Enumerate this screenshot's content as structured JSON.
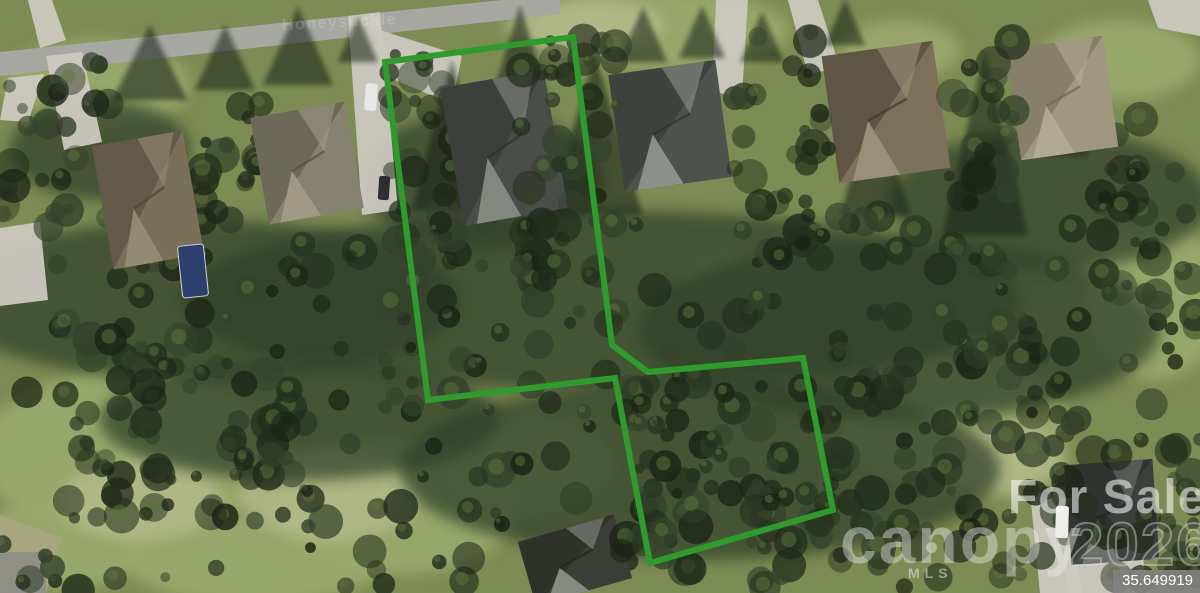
{
  "watermarks": {
    "street_label": "Honeysuckle",
    "for_sale": "For Sale",
    "brand": "canopy",
    "brand_sub": "MLS",
    "year": "2026"
  },
  "coordinate_badge": {
    "value": "35.649919"
  },
  "parcel_boundary": {
    "color": "#2f9b2d",
    "stroke_width": 6,
    "points": [
      [
        385,
        62
      ],
      [
        573,
        37
      ],
      [
        612,
        345
      ],
      [
        648,
        372
      ],
      [
        803,
        358
      ],
      [
        833,
        510
      ],
      [
        650,
        563
      ],
      [
        615,
        378
      ],
      [
        428,
        400
      ]
    ]
  },
  "palette": {
    "grass_base": "#7d8b54",
    "grass_light": "#9cab6e",
    "grass_pale": "#b6bc8c",
    "tree_dark": "#222e1b",
    "tree_mid": "#33422a",
    "tree_deep": "#1a2414",
    "tree_light": "#5d7340",
    "road": "#a7a8a2",
    "concrete": "#ccc9bf",
    "shadow": "rgba(20,28,16,0.55)"
  },
  "scene": {
    "road": [
      [
        0,
        52
      ],
      [
        560,
        -6
      ],
      [
        560,
        14
      ],
      [
        0,
        76
      ]
    ],
    "driveways": [
      {
        "pts": [
          [
            28,
            0
          ],
          [
            52,
            0
          ],
          [
            66,
            40
          ],
          [
            40,
            48
          ]
        ]
      },
      {
        "pts": [
          [
            8,
            78
          ],
          [
            44,
            74
          ],
          [
            28,
            122
          ],
          [
            0,
            120
          ]
        ]
      },
      {
        "pts": [
          [
            46,
            56
          ],
          [
            82,
            52
          ],
          [
            102,
            142
          ],
          [
            64,
            150
          ]
        ]
      },
      {
        "pts": [
          [
            0,
            228
          ],
          [
            40,
            222
          ],
          [
            48,
            300
          ],
          [
            0,
            306
          ]
        ]
      },
      {
        "pts": [
          [
            348,
            16
          ],
          [
            380,
            12
          ],
          [
            398,
            210
          ],
          [
            362,
            215
          ]
        ]
      },
      {
        "pts": [
          [
            380,
            30
          ],
          [
            462,
            56
          ],
          [
            452,
            104
          ],
          [
            376,
            72
          ]
        ]
      },
      {
        "pts": [
          [
            716,
            0
          ],
          [
            748,
            0
          ],
          [
            742,
            96
          ],
          [
            712,
            92
          ]
        ]
      },
      {
        "pts": [
          [
            788,
            0
          ],
          [
            818,
            0
          ],
          [
            840,
            68
          ],
          [
            808,
            74
          ]
        ]
      },
      {
        "pts": [
          [
            1148,
            0
          ],
          [
            1200,
            0
          ],
          [
            1200,
            36
          ],
          [
            1158,
            28
          ]
        ]
      },
      {
        "pts": [
          [
            1030,
            492
          ],
          [
            1064,
            488
          ],
          [
            1082,
            593
          ],
          [
            1040,
            593
          ]
        ]
      },
      {
        "pts": [
          [
            1064,
            556
          ],
          [
            1140,
            548
          ],
          [
            1150,
            593
          ],
          [
            1068,
            593
          ]
        ]
      },
      {
        "pts": [
          [
            0,
            515
          ],
          [
            62,
            538
          ],
          [
            46,
            593
          ],
          [
            0,
            593
          ]
        ],
        "fill": "#a9a582"
      },
      {
        "pts": [
          [
            0,
            552
          ],
          [
            46,
            552
          ],
          [
            46,
            593
          ],
          [
            0,
            593
          ]
        ],
        "fill": "#8e8e86"
      }
    ],
    "grass_patches": [
      [
        130,
        455,
        150,
        85
      ],
      [
        395,
        505,
        125,
        70
      ],
      [
        95,
        85,
        95,
        45
      ],
      [
        660,
        30,
        130,
        40
      ],
      [
        955,
        425,
        115,
        70
      ],
      [
        1155,
        300,
        70,
        80
      ],
      [
        255,
        560,
        130,
        45
      ],
      [
        530,
        465,
        85,
        50
      ],
      [
        735,
        280,
        55,
        32
      ],
      [
        60,
        545,
        90,
        45
      ],
      [
        900,
        50,
        60,
        30
      ],
      [
        1120,
        60,
        80,
        40
      ]
    ],
    "pale_patches": [
      [
        330,
        495,
        90,
        45
      ],
      [
        140,
        500,
        80,
        40
      ],
      [
        1005,
        460,
        60,
        35
      ],
      [
        585,
        25,
        80,
        25
      ]
    ],
    "forest_blobs": [
      [
        600,
        300,
        420,
        90
      ],
      [
        200,
        300,
        260,
        80
      ],
      [
        900,
        330,
        260,
        90
      ],
      [
        700,
        470,
        300,
        90
      ],
      [
        300,
        420,
        200,
        60
      ],
      [
        1050,
        200,
        160,
        70
      ],
      [
        480,
        180,
        120,
        70
      ],
      [
        100,
        150,
        90,
        50
      ]
    ],
    "pine_shadows": [
      [
        150,
        100,
        75,
        75
      ],
      [
        225,
        90,
        60,
        65
      ],
      [
        298,
        85,
        70,
        78
      ],
      [
        358,
        62,
        40,
        46
      ],
      [
        452,
        210,
        80,
        150
      ],
      [
        595,
        215,
        95,
        160
      ],
      [
        643,
        62,
        48,
        55
      ],
      [
        702,
        58,
        46,
        52
      ],
      [
        762,
        62,
        44,
        50
      ],
      [
        845,
        45,
        40,
        46
      ],
      [
        985,
        235,
        85,
        185
      ],
      [
        1060,
        155,
        55,
        110
      ],
      [
        875,
        215,
        70,
        120
      ],
      [
        520,
        95,
        55,
        90
      ]
    ],
    "tree_bands": [
      {
        "x": 0,
        "y": 215,
        "w": 1200,
        "h": 330,
        "n": 230,
        "pass": 1
      },
      {
        "x": 0,
        "y": 545,
        "w": 1200,
        "h": 46,
        "n": 50,
        "pass": 1
      },
      {
        "x": 0,
        "y": 60,
        "w": 110,
        "h": 180,
        "n": 26,
        "pass": 1
      },
      {
        "x": 195,
        "y": 70,
        "w": 70,
        "h": 160,
        "n": 18,
        "pass": 1
      },
      {
        "x": 385,
        "y": 50,
        "w": 75,
        "h": 260,
        "n": 34,
        "pass": 1
      },
      {
        "x": 60,
        "y": 330,
        "w": 260,
        "h": 200,
        "n": 40,
        "pass": 1
      },
      {
        "x": 830,
        "y": 330,
        "w": 240,
        "h": 200,
        "n": 46,
        "pass": 1
      },
      {
        "x": 1095,
        "y": 110,
        "w": 105,
        "h": 230,
        "n": 28,
        "pass": 1
      },
      {
        "x": 520,
        "y": 35,
        "w": 110,
        "h": 280,
        "n": 44,
        "pass": 2
      },
      {
        "x": 730,
        "y": 30,
        "w": 100,
        "h": 230,
        "n": 34,
        "pass": 2
      },
      {
        "x": 940,
        "y": 40,
        "w": 75,
        "h": 250,
        "n": 30,
        "pass": 2
      },
      {
        "x": 620,
        "y": 370,
        "w": 220,
        "h": 190,
        "n": 60,
        "pass": 2
      },
      {
        "x": 1060,
        "y": 430,
        "w": 140,
        "h": 120,
        "n": 20,
        "pass": 2
      }
    ],
    "houses": [
      {
        "cx": 148,
        "cy": 200,
        "w": 92,
        "h": 125,
        "angle": -10,
        "base": "#7a6f58",
        "dark": "#4a4438",
        "light": "#958b74"
      },
      {
        "cx": 307,
        "cy": 163,
        "w": 96,
        "h": 108,
        "angle": -10,
        "base": "#87816f",
        "dark": "#54503f",
        "light": "#a09a86"
      },
      {
        "cx": 504,
        "cy": 148,
        "w": 105,
        "h": 140,
        "angle": -10,
        "base": "#4a4e48",
        "dark": "#2e312c",
        "light": "#868b82"
      },
      {
        "cx": 670,
        "cy": 126,
        "w": 108,
        "h": 118,
        "angle": -8,
        "base": "#4e524c",
        "dark": "#303330",
        "light": "#8f938b"
      },
      {
        "cx": 886,
        "cy": 112,
        "w": 112,
        "h": 128,
        "angle": -8,
        "base": "#7e715a",
        "dark": "#3f3a2e",
        "light": "#9c9179"
      },
      {
        "cx": 1062,
        "cy": 98,
        "w": 98,
        "h": 112,
        "angle": -8,
        "base": "#a0977f",
        "dark": "#6e6753",
        "light": "#b3ab94"
      },
      {
        "cx": 1112,
        "cy": 512,
        "w": 88,
        "h": 100,
        "angle": -4,
        "base": "#3c403c",
        "dark": "#242724",
        "light": "#6f736c"
      },
      {
        "cx": 575,
        "cy": 560,
        "w": 100,
        "h": 66,
        "angle": -16,
        "base": "#3a3e36",
        "dark": "#23261f",
        "light": "#8b8e85"
      }
    ],
    "pool": {
      "cx": 193,
      "cy": 271,
      "w": 26,
      "h": 52,
      "angle": -6,
      "fill": "#2c3f6d"
    },
    "vehicles": [
      {
        "cx": 371,
        "cy": 97,
        "w": 12,
        "h": 27,
        "angle": 4,
        "fill": "#e8e8e4"
      },
      {
        "cx": 384,
        "cy": 188,
        "w": 11,
        "h": 24,
        "angle": 4,
        "fill": "#2c2e30"
      },
      {
        "cx": 1062,
        "cy": 522,
        "w": 13,
        "h": 32,
        "angle": 2,
        "fill": "#ececea"
      }
    ]
  }
}
